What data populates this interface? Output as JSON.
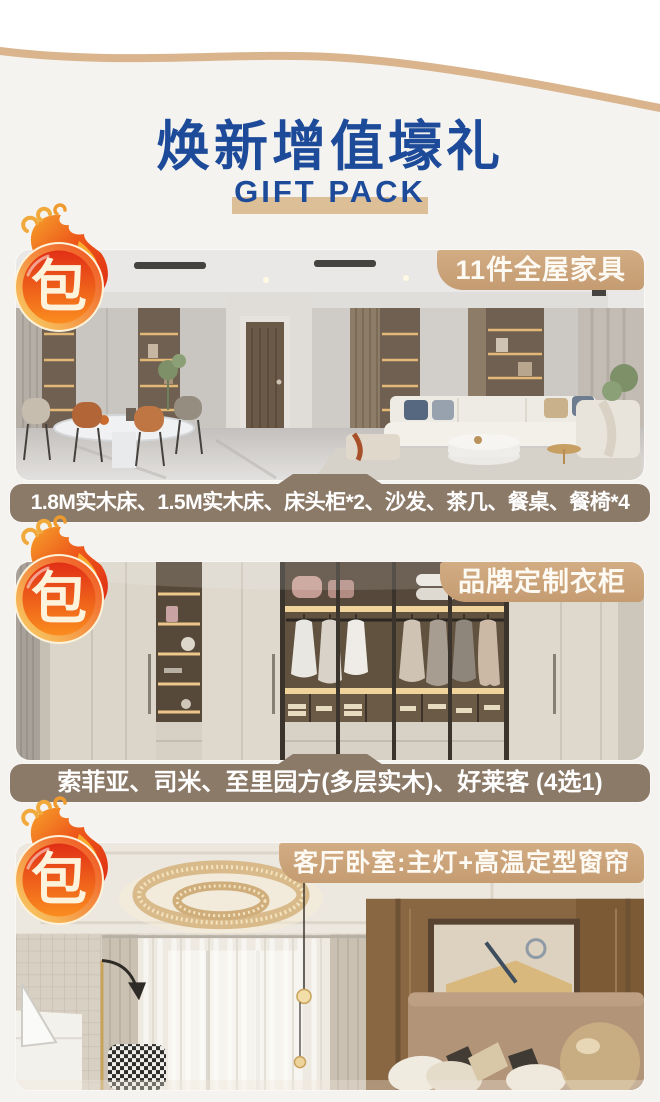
{
  "page": {
    "title": "焕新增值壕礼",
    "subtitle": "GIFT PACK"
  },
  "sections": [
    {
      "badge": "包",
      "tag": "11件全屋家具",
      "caption": "1.8M实木床、1.5M实木床、床头柜*2、沙发、茶几、餐桌、餐椅*4",
      "photo": "living-dining-room-photo"
    },
    {
      "badge": "包",
      "tag": "品牌定制衣柜",
      "caption": "索菲亚、司米、至里园方(多层实木)、好莱客 (4选1)",
      "photo": "custom-wardrobe-photo"
    },
    {
      "badge": "包",
      "tag": "客厅卧室:主灯+高温定型窗帘",
      "caption": "",
      "photo": "bedroom-lamp-curtain-photo"
    }
  ],
  "colors": {
    "background": "#f4f3f0",
    "title_blue": "#1d4b99",
    "tan_accent": "#cda47a",
    "subtitle_bar": "#dcbf97",
    "caption_brown": "#8c7a69",
    "badge_red": "#e23318",
    "badge_orange": "#f78c1e",
    "badge_gold": "#f7c354",
    "label_text": "#ffffff"
  }
}
